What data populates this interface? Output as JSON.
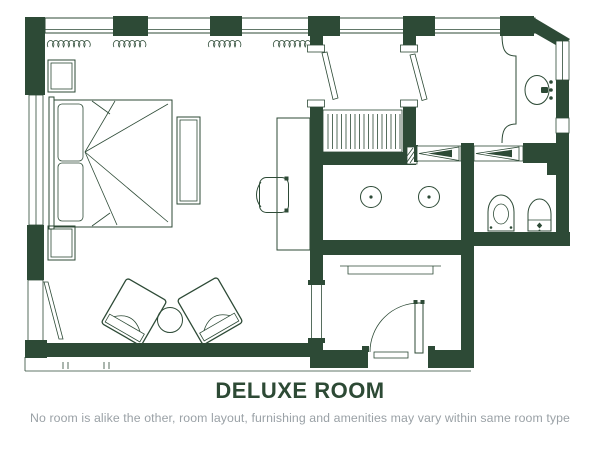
{
  "caption": {
    "title": "DELUXE ROOM",
    "subtitle": "No room is alike the other, room layout, furnishing and amenities may vary within same room type"
  },
  "colors": {
    "wall": "#2d4a36",
    "title_text": "#2d4a35",
    "subtitle_text": "#9aa1a6",
    "background": "#ffffff"
  },
  "floorplan": {
    "type": "hotel-room-floor-plan",
    "rooms": [
      "bedroom",
      "dressing-vestibule",
      "wardrobe-closet",
      "vanity-area",
      "shower-room",
      "water-closet",
      "entry-hall"
    ],
    "fixtures": [
      "king-bed",
      "pillows",
      "nightstands",
      "luggage-bench",
      "desk",
      "desk-chair",
      "armchairs",
      "coffee-table",
      "curtains",
      "hanging-rail",
      "vanity-sink",
      "shower-heads",
      "toilet",
      "bidet",
      "entry-swing-door",
      "sliding-doors",
      "windows"
    ]
  }
}
